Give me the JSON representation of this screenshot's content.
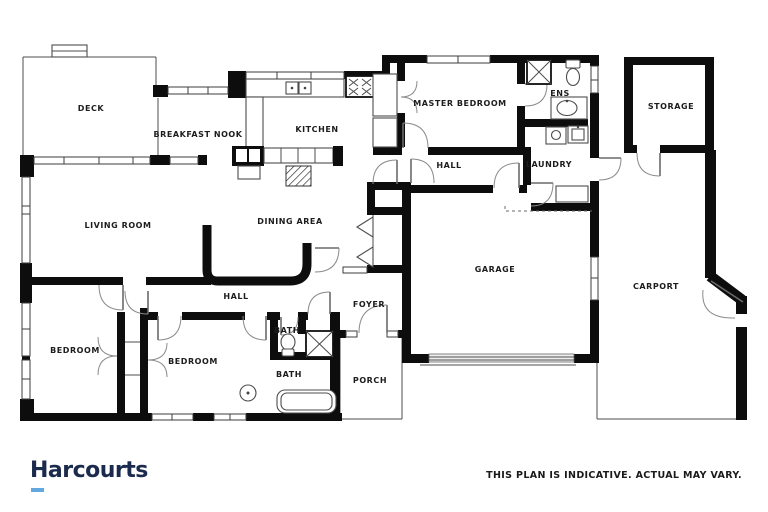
{
  "branding": {
    "logo_text": "Harcourts",
    "logo_color": "#1b2b4d",
    "logo_underline_color": "#63a9e0"
  },
  "disclaimer": "THIS PLAN IS INDICATIVE. ACTUAL MAY VARY.",
  "colors": {
    "wall": "#0d0d0d",
    "background": "#ffffff",
    "thin_line": "#4d4d4d"
  },
  "rooms": [
    {
      "id": "deck",
      "label": "DECK"
    },
    {
      "id": "breakfast-nook",
      "label": "BREAKFAST NOOK"
    },
    {
      "id": "kitchen",
      "label": "KITCHEN"
    },
    {
      "id": "master-bedroom",
      "label": "MASTER BEDROOM"
    },
    {
      "id": "ensuite",
      "label": "ENS"
    },
    {
      "id": "storage",
      "label": "STORAGE"
    },
    {
      "id": "hall-upper",
      "label": "HALL"
    },
    {
      "id": "laundry",
      "label": "LAUNDRY"
    },
    {
      "id": "living-room",
      "label": "LIVING ROOM"
    },
    {
      "id": "dining-area",
      "label": "DINING AREA"
    },
    {
      "id": "garage",
      "label": "GARAGE"
    },
    {
      "id": "carport",
      "label": "CARPORT"
    },
    {
      "id": "hall-lower",
      "label": "HALL"
    },
    {
      "id": "foyer",
      "label": "FOYER"
    },
    {
      "id": "bedroom-1",
      "label": "BEDROOM"
    },
    {
      "id": "bedroom-2",
      "label": "BEDROOM"
    },
    {
      "id": "bath-upper",
      "label": "BATH"
    },
    {
      "id": "bath-lower",
      "label": "BATH"
    },
    {
      "id": "porch",
      "label": "PORCH"
    }
  ]
}
